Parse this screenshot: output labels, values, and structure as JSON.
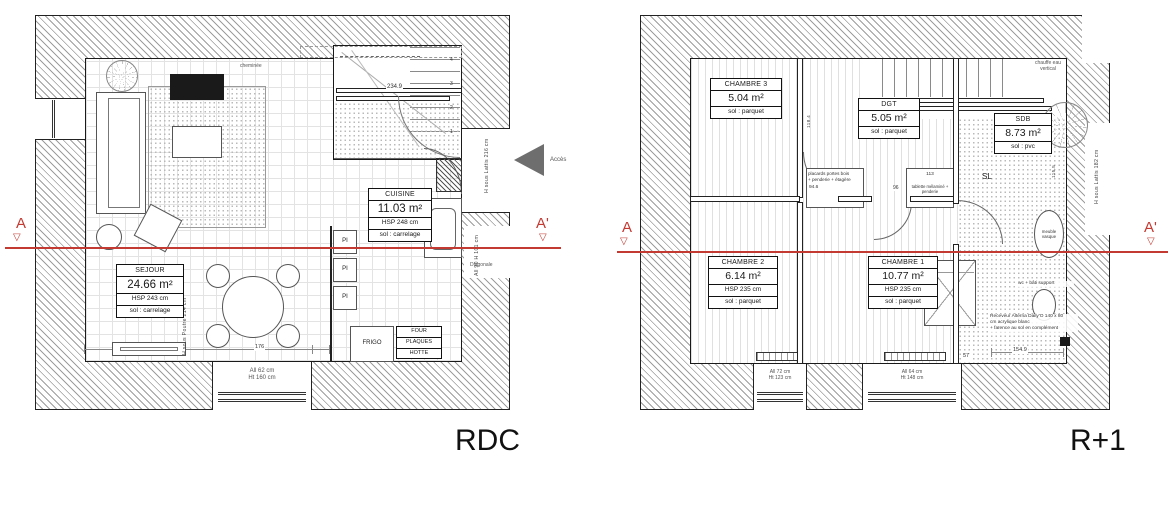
{
  "titles": {
    "rdc": "RDC",
    "r1": "R+1"
  },
  "section_markers": {
    "a": "A",
    "a_prime": "A'",
    "tri": "▽"
  },
  "access_label": "Accès",
  "colors": {
    "section_line": "#c23a32",
    "access_arrow": "#6e6e6e"
  },
  "rdc": {
    "sejour": {
      "name": "SEJOUR",
      "area": "24.66 m²",
      "hsp": "HSP 243 cm",
      "floor": "sol : carrelage"
    },
    "cuisine": {
      "name": "CUISINE",
      "area": "11.03 m²",
      "hsp": "HSP 248 cm",
      "floor": "sol : carrelage"
    },
    "frigo": "FRIGO",
    "four": "FOUR",
    "plaques": "PLAQUES",
    "hotte": "HOTTE",
    "pi": "PI",
    "cheminee": "cheminée",
    "window": {
      "line1": "All 62 cm",
      "line2": "Ht 160 cm"
    },
    "dim_bottom_1": "228",
    "dim_bottom_2": "176",
    "dim_stairs": "234.9",
    "stair_steps": [
      "1",
      "2",
      "3",
      "4"
    ],
    "note_poutre": "H sous Poutre 214 cm",
    "note_lattis216": "H sous Lattis 216 cm",
    "note_allege": "All 90 H 101 cm",
    "note_diagonale": "Diagonale"
  },
  "r1": {
    "chambre3": {
      "name": "CHAMBRE 3",
      "area": "5.04 m²",
      "floor": "sol : parquet"
    },
    "dgt": {
      "name": "DGT",
      "area": "5.05 m²",
      "floor": "sol : parquet"
    },
    "sdb": {
      "name": "SDB",
      "area": "8.73 m²",
      "floor": "sol : pvc"
    },
    "chambre2": {
      "name": "CHAMBRE 2",
      "area": "6.14 m²",
      "hsp": "HSP 235 cm",
      "floor": "sol : parquet"
    },
    "chambre1": {
      "name": "CHAMBRE 1",
      "area": "10.77 m²",
      "hsp": "HSP 235 cm",
      "floor": "sol : parquet"
    },
    "chauffe_l1": "chauffe eau",
    "chauffe_l2": "vertical",
    "sl": "SL",
    "placards_l1": "placards portes bois",
    "placards_l2": "+ penderie + étagère",
    "tablette": "tablette mélaminé + penderie",
    "meuble_l1": "meuble",
    "meuble_l2": "vasque",
    "wc": "wc + bâti support",
    "receveur_l1": "Receveur Alterna Daily'O 140 x 80",
    "receveur_l2": "cm acrylique blanc",
    "receveur_l3": "+ faïence au sol en complément",
    "window1": {
      "line1": "All 72 cm",
      "line2": "Ht 123 cm"
    },
    "window2": {
      "line1": "All 64 cm",
      "line2": "Ht 148 cm"
    },
    "dim_946": "94.6",
    "dim_96": "96",
    "dim_113": "113",
    "dim_1155": "115.5",
    "dim_1184": "118.4",
    "dim_1549": "154.9",
    "dim_57": "57",
    "note_lattis182": "H sous Lattis 182 cm"
  }
}
